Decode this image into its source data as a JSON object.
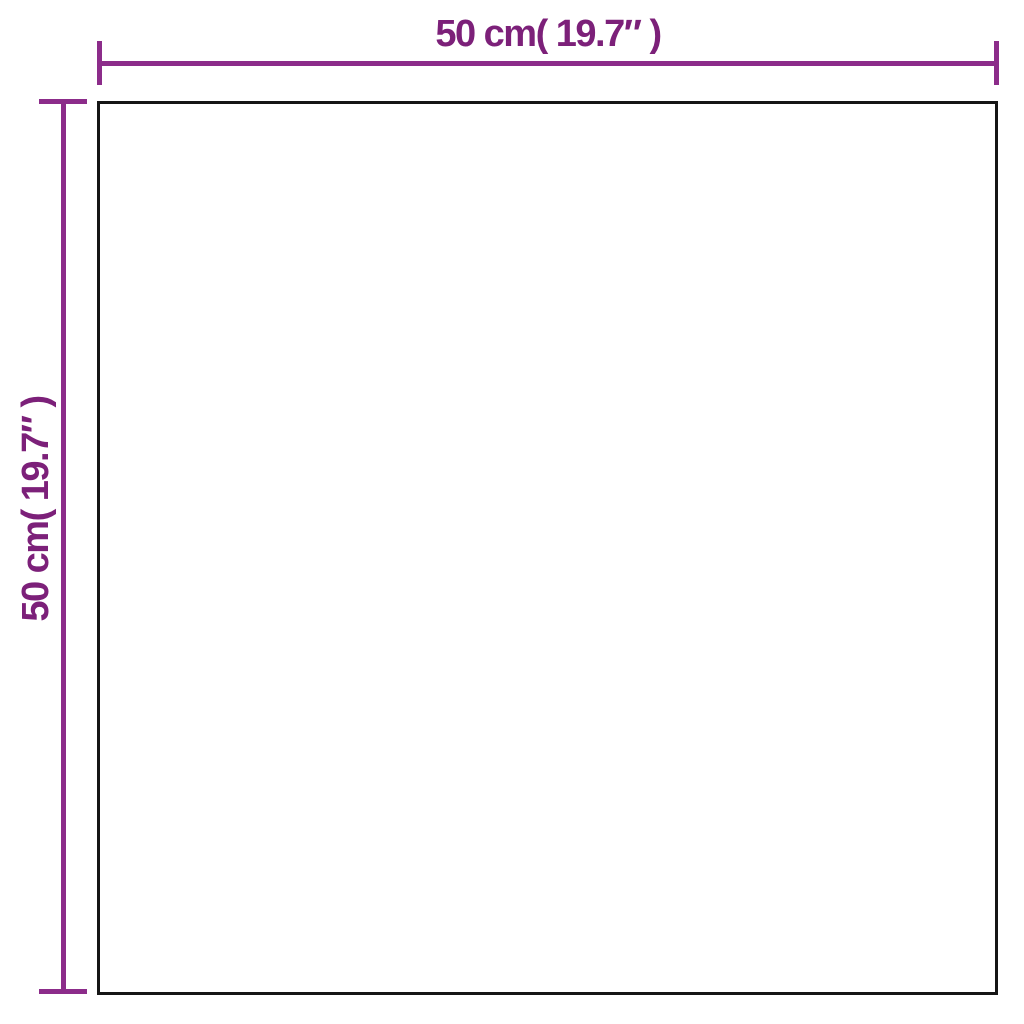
{
  "diagram": {
    "type": "product-dimension-diagram",
    "labels": {
      "top": "50 cm( 19.7″ )",
      "left": "50 cm( 19.7″ )"
    },
    "dimensions": {
      "width_cm": 50,
      "width_in": 19.7,
      "height_cm": 50,
      "height_in": 19.7
    }
  },
  "colors": {
    "accent": "#8C2C8A",
    "label": "#7C2079",
    "outline": "#161616",
    "background": "#FFFFFF"
  }
}
